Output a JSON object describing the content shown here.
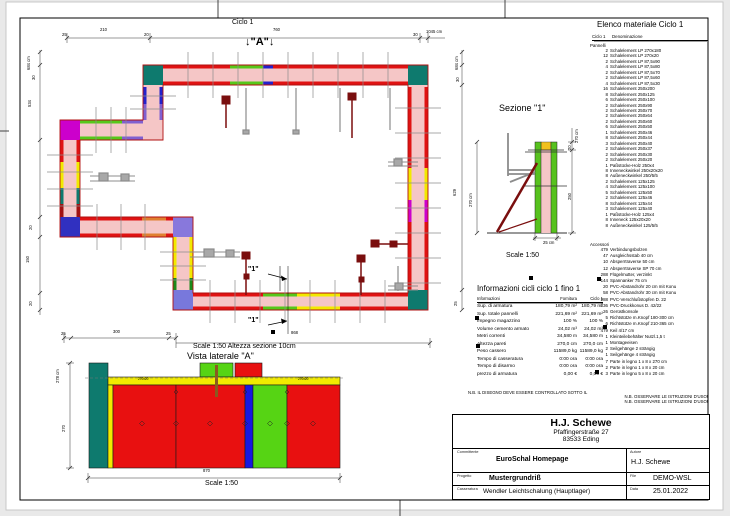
{
  "plan": {
    "title": "Ciclo 1",
    "marker_a": "↓\"A\"↓",
    "marker_1": "\"1\""
  },
  "side_view": {
    "subtitle": "Scale 1:50  Altezza sezione 10cm",
    "title": "Vista laterale \"A\"",
    "scale": "Scale 1:50",
    "panel_labels": [
      "270x20",
      "270x20"
    ]
  },
  "section": {
    "title": "Sezione \"1\"",
    "scale": "Scale 1:50"
  },
  "dims": {
    "plan_top": [
      "25",
      "210",
      "20",
      "760",
      "30",
      "1045 cm"
    ],
    "plan_left": [
      "684 cm",
      "30",
      "534",
      "20",
      "150",
      "20"
    ],
    "plan_right": [
      "684 cm",
      "30",
      "629",
      "25"
    ],
    "plan_bottom": [
      "25",
      "300",
      "25",
      "868"
    ],
    "side_left": [
      "278 cm",
      "270"
    ],
    "side_bottom": "870",
    "sec_left": "270 cm",
    "sec_right": [
      "270 cm",
      "20",
      "250"
    ],
    "sec_bottom": "25 cm"
  },
  "info_table": {
    "title": "Informazioni cicli  ciclo 1 fino 1",
    "headers": [
      "Informazioni",
      "Fornitura",
      "Ciclo 1"
    ],
    "rows": [
      [
        "Sup. di armatura",
        "180,79 m²",
        "180,79 m²"
      ],
      [
        "Sup. totale pannelli",
        "221,69 m²",
        "221,69 m²"
      ],
      [
        "Impegno magazzino",
        "100 %",
        "100 %"
      ],
      [
        "Volume cemento armato",
        "24,02 m³",
        "24,02 m³"
      ],
      [
        "Metri correnti",
        "34,580 m",
        "34,580 m"
      ],
      [
        "Altezza pareti",
        "270,0 cm",
        "270,0 cm"
      ],
      [
        "Peso cassero",
        "11589,0 kg",
        "11589,0 kg"
      ],
      [
        "Tempo di casseratura",
        "0:00 ora",
        "0:00 ora"
      ],
      [
        "Tempo di disarmo",
        "0:00 ora",
        "0:00 ora"
      ],
      [
        "prezzo di armatura",
        "0,00 €",
        "0,00 €"
      ]
    ]
  },
  "material_list": {
    "title": "Elenco materiale  Ciclo 1",
    "header_cycle": "Ciclo 1",
    "header_name": "Denominazione",
    "group_panels": "Pannelli",
    "group_accessories": "Accessori",
    "panels": [
      [
        "2",
        "Schalelement LP 270x180"
      ],
      [
        "12",
        "Schalelement LP 270x20"
      ],
      [
        "2",
        "Schalelement LP 87,5x90"
      ],
      [
        "4",
        "Schalelement LP 87,5x80"
      ],
      [
        "2",
        "Schalelement LP 87,5x70"
      ],
      [
        "2",
        "Schalelement LP 87,5x60"
      ],
      [
        "4",
        "Schalelement LP 87,5x30"
      ],
      [
        "16",
        "Schalelement 250x200"
      ],
      [
        "8",
        "Schalelement 250x125"
      ],
      [
        "6",
        "Schalelement 250x100"
      ],
      [
        "2",
        "Schalelement 250x90"
      ],
      [
        "2",
        "Schalelement 250x70"
      ],
      [
        "2",
        "Schalelement 250x64"
      ],
      [
        "2",
        "Schalelement 250x60"
      ],
      [
        "6",
        "Schalelement 250x50"
      ],
      [
        "1",
        "Schalelement 250x46"
      ],
      [
        "8",
        "Schalelement 250x44"
      ],
      [
        "3",
        "Schalelement 250x40"
      ],
      [
        "2",
        "Schalelement 250x37"
      ],
      [
        "2",
        "Schalelement 250x30"
      ],
      [
        "2",
        "Schalelement 250x20"
      ],
      [
        "1",
        "Paßstücke-Holz 250x4"
      ],
      [
        "8",
        "Inneneckwinkel 250x20x20"
      ],
      [
        "8",
        "Außeneckwinkel 250/5/5"
      ],
      [
        "2",
        "Schalelement 125x125"
      ],
      [
        "4",
        "Schalelement 125x100"
      ],
      [
        "5",
        "Schalelement 125x50"
      ],
      [
        "2",
        "Schalelement 125x46"
      ],
      [
        "8",
        "Schalelement 125x44"
      ],
      [
        "3",
        "Schalelement 125x40"
      ],
      [
        "1",
        "Paßstücke-Holz 125x4"
      ],
      [
        "8",
        "Inneneck 125x20x20"
      ],
      [
        "8",
        "Außeneckwinkel 125/5/5"
      ]
    ],
    "accessories": [
      [
        "479",
        "Verbindungsbolzen"
      ],
      [
        "47",
        "Ausgleichsstab 40 cm"
      ],
      [
        "10",
        "Absperrtraverse 50 cm"
      ],
      [
        "12",
        "Absperrtraverse SP 70 cm"
      ],
      [
        "288",
        "Flügelmutter, verzinkt"
      ],
      [
        "144",
        "Spannanker 75 cm"
      ],
      [
        "20",
        "PVC-Abstandrohr 20 cm mit Konu"
      ],
      [
        "58",
        "PVC-Abstandrohr 30 cm mit Konu"
      ],
      [
        "288",
        "PVC-Verschlußstopfen D. 22"
      ],
      [
        "136",
        "PVC-Druckkonus D. 42/22"
      ],
      [
        "26",
        "Gerüstkonsole"
      ],
      [
        "5",
        "Richtstütze m.Knopf 180-300 cm"
      ],
      [
        "6",
        "Richtstütze m.Knopf 210-365 cm"
      ],
      [
        "479",
        "Keil 4/17 cm"
      ],
      [
        "1",
        "Kleinteilebehälter Nutzl.1,5 t"
      ],
      [
        "1",
        "Montageeisen"
      ],
      [
        "2",
        "Seilgehänge 2 strängig"
      ],
      [
        "1",
        "Seilgehänge 4 strängig"
      ],
      [
        "7",
        "Parte in legno 1 x 8 x 270 cm"
      ],
      [
        "2",
        "Parte in legno 1 x 8 x 20 cm"
      ],
      [
        "3",
        "Parte in legno 5 x 8 x 20 cm"
      ]
    ]
  },
  "notes": [
    "N.B. IL DISEGNO DEVE ESSERE CONTROLLATO SOTTO IL",
    "N.B. OSSERVARE LE ISTRUZIONI D'USO!",
    "N.B. OSSERVARE LE ISTRUZIONI D'USO!"
  ],
  "title_block": {
    "company": "H.J. Schewe",
    "address1": "Pfaffingerstraße 27",
    "address2": "83533 Eding",
    "labels": {
      "client": "Committente",
      "author": "Autore",
      "project": "Progetto",
      "file": "File",
      "formwork": "Casseratura",
      "date": "Data"
    },
    "values": {
      "client": "EuroSchal Homepage",
      "author": "H.J. Schewe",
      "project": "Mustergrundriß",
      "file": "DEMO-WSL",
      "formwork": "Wendler Leichtschalung (Hauptlager)",
      "date": "25.01.2022"
    }
  },
  "colors": {
    "wall_fill": "#f5c6c6",
    "element_red": "#e01212",
    "element_green": "#56c81a",
    "element_yellow": "#f2ea00",
    "element_blue": "#2222cc",
    "element_magenta": "#cc00cc",
    "element_teal": "#0e7a6e",
    "element_orange": "#e08030",
    "prop_dark_red": "#7a0e0e",
    "brace_gray": "#8c8c8c"
  }
}
